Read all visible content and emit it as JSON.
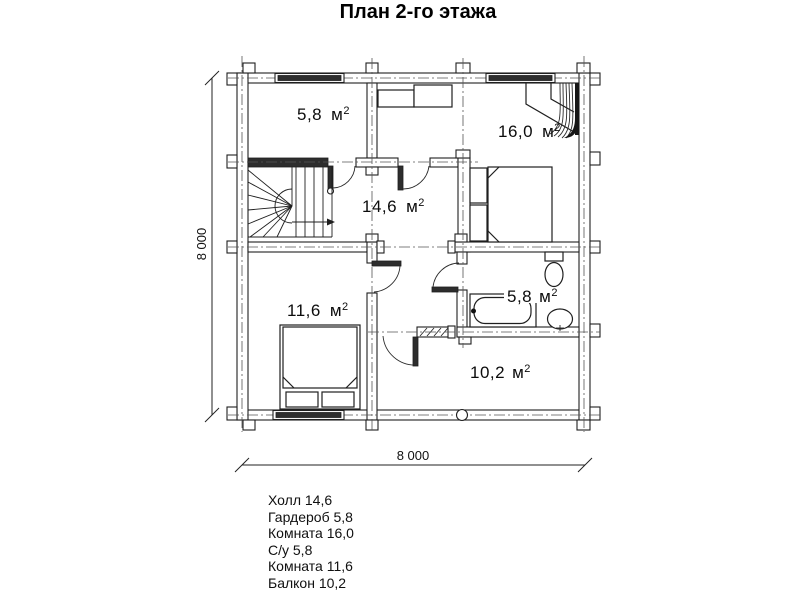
{
  "title": "План 2-го этажа",
  "unit": {
    "m": "м",
    "sup": "2"
  },
  "dimensions": {
    "width": "8 000",
    "height": "8 000"
  },
  "rooms": {
    "wardrobe": {
      "area": "5,8"
    },
    "bedroom16": {
      "area": "16,0"
    },
    "hall": {
      "area": "14,6"
    },
    "bedroom11": {
      "area": "11,6"
    },
    "bathroom": {
      "area": "5,8"
    },
    "balcony": {
      "area": "10,2"
    }
  },
  "legend": {
    "items": [
      "Холл 14,6",
      "Гардероб 5,8",
      "Комната 16,0",
      "С/у 5,8",
      "Комната 11,6",
      "Балкон 10,2"
    ]
  }
}
